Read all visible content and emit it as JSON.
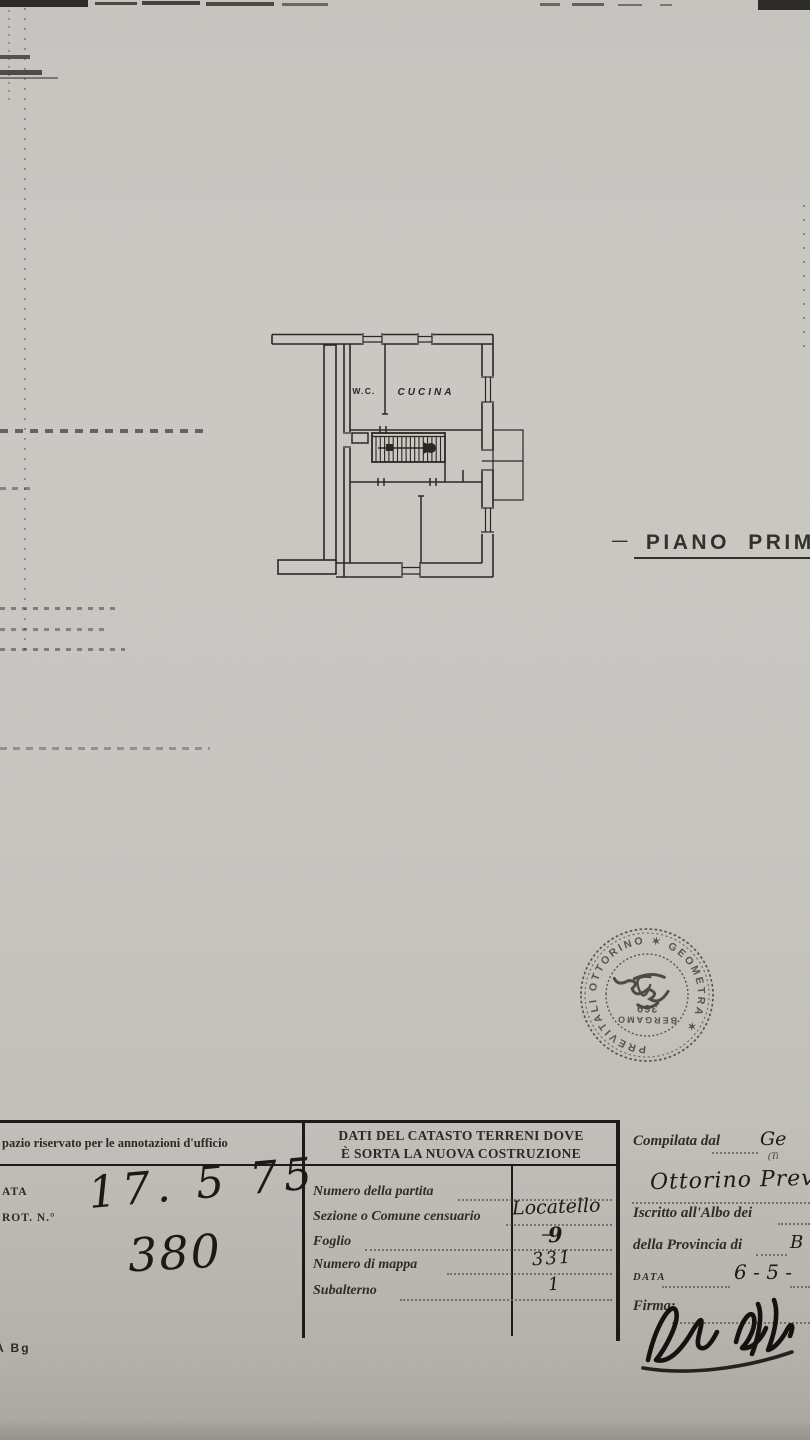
{
  "plan": {
    "label_wc": "W.C.",
    "label_cucina": "CUCINA",
    "caption_dash": "‒‒",
    "caption": "PIANO PRIMO"
  },
  "stamp": {
    "ring_text": "PREVITALI  OTTORINO  ✶  GEOMETRA  ✶",
    "city": "BERGAMO",
    "number": "369"
  },
  "form": {
    "left_header": "pazio riservato per le annotazioni d'ufficio",
    "right_header_line1": "DATI DEL CATASTO TERRENI DOVE",
    "right_header_line2": "È SORTA LA NUOVA COSTRUZIONE",
    "label_data": "ATA",
    "label_prot": "ROT. N.°",
    "hw_date": "17. 5 75",
    "hw_number": "380",
    "fields": [
      {
        "label": "Numero della partita",
        "value": ""
      },
      {
        "label": "Sezione o Comune censuario",
        "value": "Locatello"
      },
      {
        "label": "Foglio",
        "value": "9"
      },
      {
        "label": "Numero di mappa",
        "value": "331"
      },
      {
        "label": "Subalterno",
        "value": "1"
      }
    ],
    "right": {
      "compilata_label": "Compilata dal",
      "compilata_value": "Ge",
      "titolo_hint": "(Ti",
      "name_value": "Ottorino Prev",
      "iscritto_label": "Iscritto all'Albo dei",
      "provincia_label": "della Provincia di",
      "provincia_value": "B",
      "data_label": "DATA",
      "data_value": "6 - 5 -",
      "firma_label": "Firma:"
    }
  },
  "footer_note": "A Bg"
}
